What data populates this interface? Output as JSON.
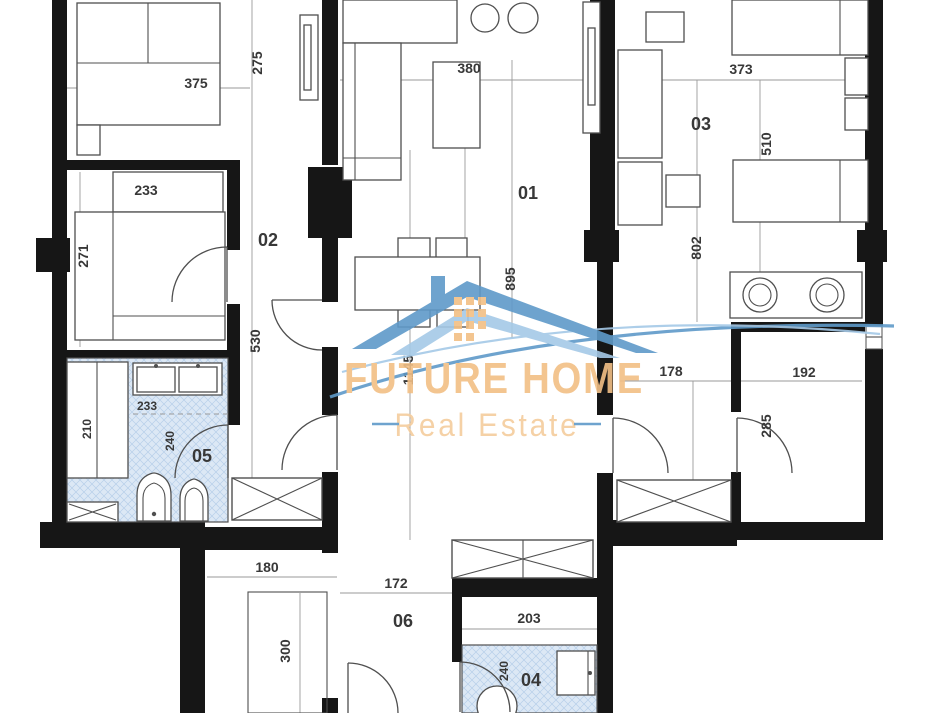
{
  "watermark": {
    "line1": "FUTURE HOME",
    "line2": "Real Estate"
  },
  "colors": {
    "wall": "#161616",
    "furniture_stroke": "#4f4f4f",
    "dim_line": "#9a9a9a",
    "label": "#383838",
    "tile_fill": "#dce8f5",
    "tile_line": "#b7cfe9",
    "logo_orange": "#f2bf85",
    "logo_orange_light": "#f4cd9d",
    "logo_blue": "#5f9ac9",
    "logo_blue_light": "#a5c9e7"
  },
  "labels": [
    {
      "text": "01",
      "x": 528,
      "y": 199,
      "type": "room"
    },
    {
      "text": "02",
      "x": 268,
      "y": 246,
      "type": "room"
    },
    {
      "text": "03",
      "x": 701,
      "y": 130,
      "type": "room"
    },
    {
      "text": "04",
      "x": 531,
      "y": 686,
      "type": "room"
    },
    {
      "text": "05",
      "x": 202,
      "y": 462,
      "type": "room"
    },
    {
      "text": "06",
      "x": 403,
      "y": 627,
      "type": "room"
    },
    {
      "text": "375",
      "x": 196,
      "y": 88,
      "type": "dim"
    },
    {
      "text": "275",
      "x": 262,
      "y": 63,
      "type": "dim",
      "rotated": true
    },
    {
      "text": "380",
      "x": 469,
      "y": 73,
      "type": "dim"
    },
    {
      "text": "373",
      "x": 741,
      "y": 74,
      "type": "dim"
    },
    {
      "text": "510",
      "x": 771,
      "y": 144,
      "type": "dim",
      "rotated": true
    },
    {
      "text": "895",
      "x": 515,
      "y": 279,
      "type": "dim",
      "rotated": true
    },
    {
      "text": "802",
      "x": 701,
      "y": 248,
      "type": "dim",
      "rotated": true
    },
    {
      "text": "233",
      "x": 146,
      "y": 195,
      "type": "dim"
    },
    {
      "text": "271",
      "x": 88,
      "y": 256,
      "type": "dim",
      "rotated": true
    },
    {
      "text": "530",
      "x": 260,
      "y": 341,
      "type": "dim",
      "rotated": true
    },
    {
      "text": "1145",
      "x": 413,
      "y": 370,
      "type": "dim",
      "rotated": true
    },
    {
      "text": "233",
      "x": 147,
      "y": 410,
      "type": "dim",
      "small": true
    },
    {
      "text": "240",
      "x": 174,
      "y": 441,
      "type": "dim",
      "rotated": true,
      "small": true
    },
    {
      "text": "210",
      "x": 91,
      "y": 429,
      "type": "dim",
      "rotated": true,
      "small": true
    },
    {
      "text": "178",
      "x": 671,
      "y": 376,
      "type": "dim"
    },
    {
      "text": "192",
      "x": 804,
      "y": 377,
      "type": "dim"
    },
    {
      "text": "285",
      "x": 771,
      "y": 426,
      "type": "dim",
      "rotated": true
    },
    {
      "text": "180",
      "x": 267,
      "y": 572,
      "type": "dim"
    },
    {
      "text": "172",
      "x": 396,
      "y": 588,
      "type": "dim"
    },
    {
      "text": "300",
      "x": 290,
      "y": 651,
      "type": "dim",
      "rotated": true
    },
    {
      "text": "203",
      "x": 529,
      "y": 623,
      "type": "dim"
    },
    {
      "text": "240",
      "x": 508,
      "y": 671,
      "type": "dim",
      "rotated": true,
      "small": true
    }
  ]
}
